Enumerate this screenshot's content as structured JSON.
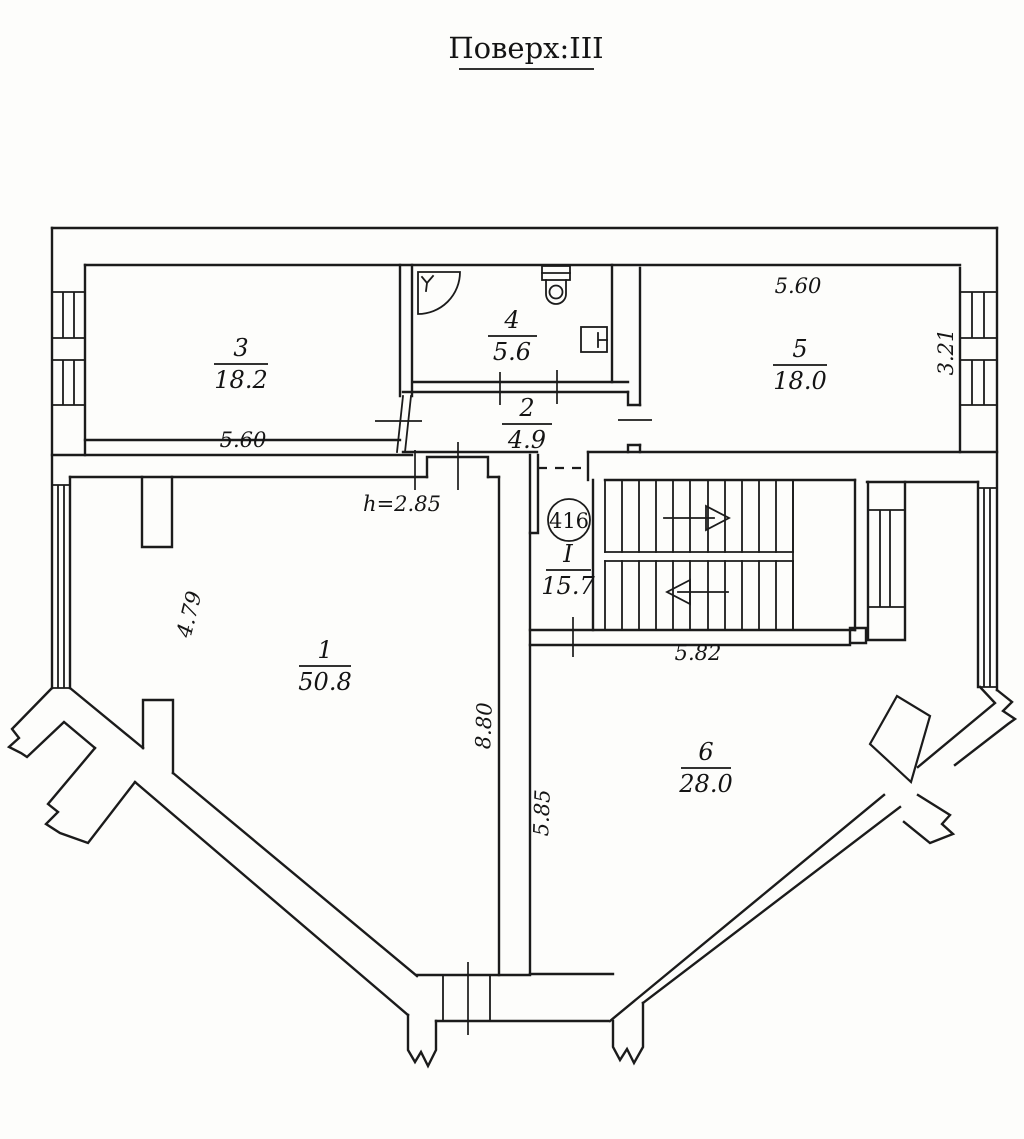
{
  "title": "Поверх:ІІІ",
  "rooms": {
    "r1": {
      "number": "1",
      "area": "50.8"
    },
    "r2": {
      "number": "2",
      "area": "4.9"
    },
    "r3": {
      "number": "3",
      "area": "18.2"
    },
    "r4": {
      "number": "4",
      "area": "5.6"
    },
    "r5": {
      "number": "5",
      "area": "18.0"
    },
    "r6": {
      "number": "6",
      "area": "28.0"
    },
    "rI": {
      "number": "I",
      "area": "15.7"
    }
  },
  "dimensions": {
    "room3_width": "5.60",
    "room5_width": "5.60",
    "room5_depth": "3.21",
    "room1_left_width": "4.79",
    "room1_right_depth": "8.80",
    "room6_left_depth": "5.85",
    "stairs_width": "5.82",
    "ceiling_height": "h=2.85"
  },
  "apartment_number": "416",
  "colors": {
    "ink": "#1b1b1b",
    "paper": "#fdfdfb"
  }
}
